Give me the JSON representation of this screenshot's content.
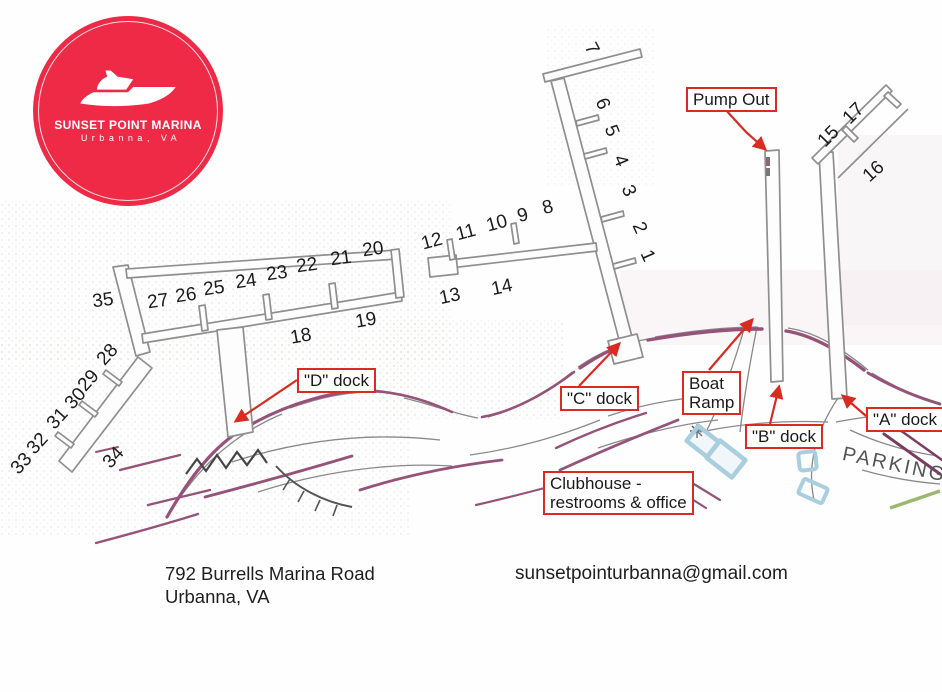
{
  "logo": {
    "name": "SUNSET POINT MARINA",
    "location": "Urbanna, VA",
    "bg_color": "#ee2a47"
  },
  "annotations": {
    "pump_out": "Pump Out",
    "d_dock": "\"D\" dock",
    "c_dock": "\"C\" dock",
    "boat_ramp_line1": "Boat",
    "boat_ramp_line2": "Ramp",
    "b_dock": "\"B\" dock",
    "a_dock": "\"A\" dock",
    "clubhouse_line1": "Clubhouse -",
    "clubhouse_line2": "restrooms & office",
    "parking": "PARKING"
  },
  "slip_numbers": [
    {
      "n": "7",
      "x": 591,
      "y": 49,
      "r": 62
    },
    {
      "n": "6",
      "x": 602,
      "y": 104,
      "r": 68
    },
    {
      "n": "5",
      "x": 611,
      "y": 131,
      "r": 68
    },
    {
      "n": "4",
      "x": 620,
      "y": 161,
      "r": 68
    },
    {
      "n": "3",
      "x": 628,
      "y": 191,
      "r": 68
    },
    {
      "n": "2",
      "x": 639,
      "y": 228,
      "r": 66
    },
    {
      "n": "1",
      "x": 647,
      "y": 256,
      "r": 66
    },
    {
      "n": "8",
      "x": 548,
      "y": 208,
      "r": -15
    },
    {
      "n": "9",
      "x": 523,
      "y": 216,
      "r": -15
    },
    {
      "n": "10",
      "x": 497,
      "y": 224,
      "r": -15
    },
    {
      "n": "11",
      "x": 466,
      "y": 233,
      "r": -15
    },
    {
      "n": "12",
      "x": 432,
      "y": 242,
      "r": -15
    },
    {
      "n": "13",
      "x": 450,
      "y": 297,
      "r": -12
    },
    {
      "n": "14",
      "x": 502,
      "y": 288,
      "r": -12
    },
    {
      "n": "20",
      "x": 373,
      "y": 250,
      "r": -8
    },
    {
      "n": "21",
      "x": 341,
      "y": 259,
      "r": -8
    },
    {
      "n": "22",
      "x": 307,
      "y": 266,
      "r": -8
    },
    {
      "n": "23",
      "x": 277,
      "y": 274,
      "r": -8
    },
    {
      "n": "24",
      "x": 246,
      "y": 282,
      "r": -8
    },
    {
      "n": "25",
      "x": 214,
      "y": 289,
      "r": -8
    },
    {
      "n": "26",
      "x": 186,
      "y": 296,
      "r": -8
    },
    {
      "n": "27",
      "x": 158,
      "y": 302,
      "r": -8
    },
    {
      "n": "35",
      "x": 103,
      "y": 301,
      "r": -8
    },
    {
      "n": "18",
      "x": 301,
      "y": 337,
      "r": -10
    },
    {
      "n": "19",
      "x": 366,
      "y": 321,
      "r": -10
    },
    {
      "n": "28",
      "x": 108,
      "y": 355,
      "r": -48
    },
    {
      "n": "29",
      "x": 89,
      "y": 381,
      "r": -48
    },
    {
      "n": "30",
      "x": 76,
      "y": 399,
      "r": -48
    },
    {
      "n": "31",
      "x": 58,
      "y": 419,
      "r": -48
    },
    {
      "n": "32",
      "x": 38,
      "y": 444,
      "r": -48
    },
    {
      "n": "33",
      "x": 22,
      "y": 464,
      "r": -48
    },
    {
      "n": "34",
      "x": 114,
      "y": 458,
      "r": -48
    },
    {
      "n": "15",
      "x": 829,
      "y": 137,
      "r": -45
    },
    {
      "n": "17",
      "x": 854,
      "y": 114,
      "r": -45
    },
    {
      "n": "16",
      "x": 874,
      "y": 172,
      "r": -42
    }
  ],
  "footer": {
    "address_line1": "792 Burrells Marina Road",
    "address_line2": "Urbanna, VA",
    "email": "sunsetpointurbanna@gmail.com"
  },
  "colors": {
    "annotation_red": "#d92b21",
    "logo_red": "#ee2a47",
    "bulkhead_purple": "#96537a",
    "building_blue": "#a9cedd"
  }
}
